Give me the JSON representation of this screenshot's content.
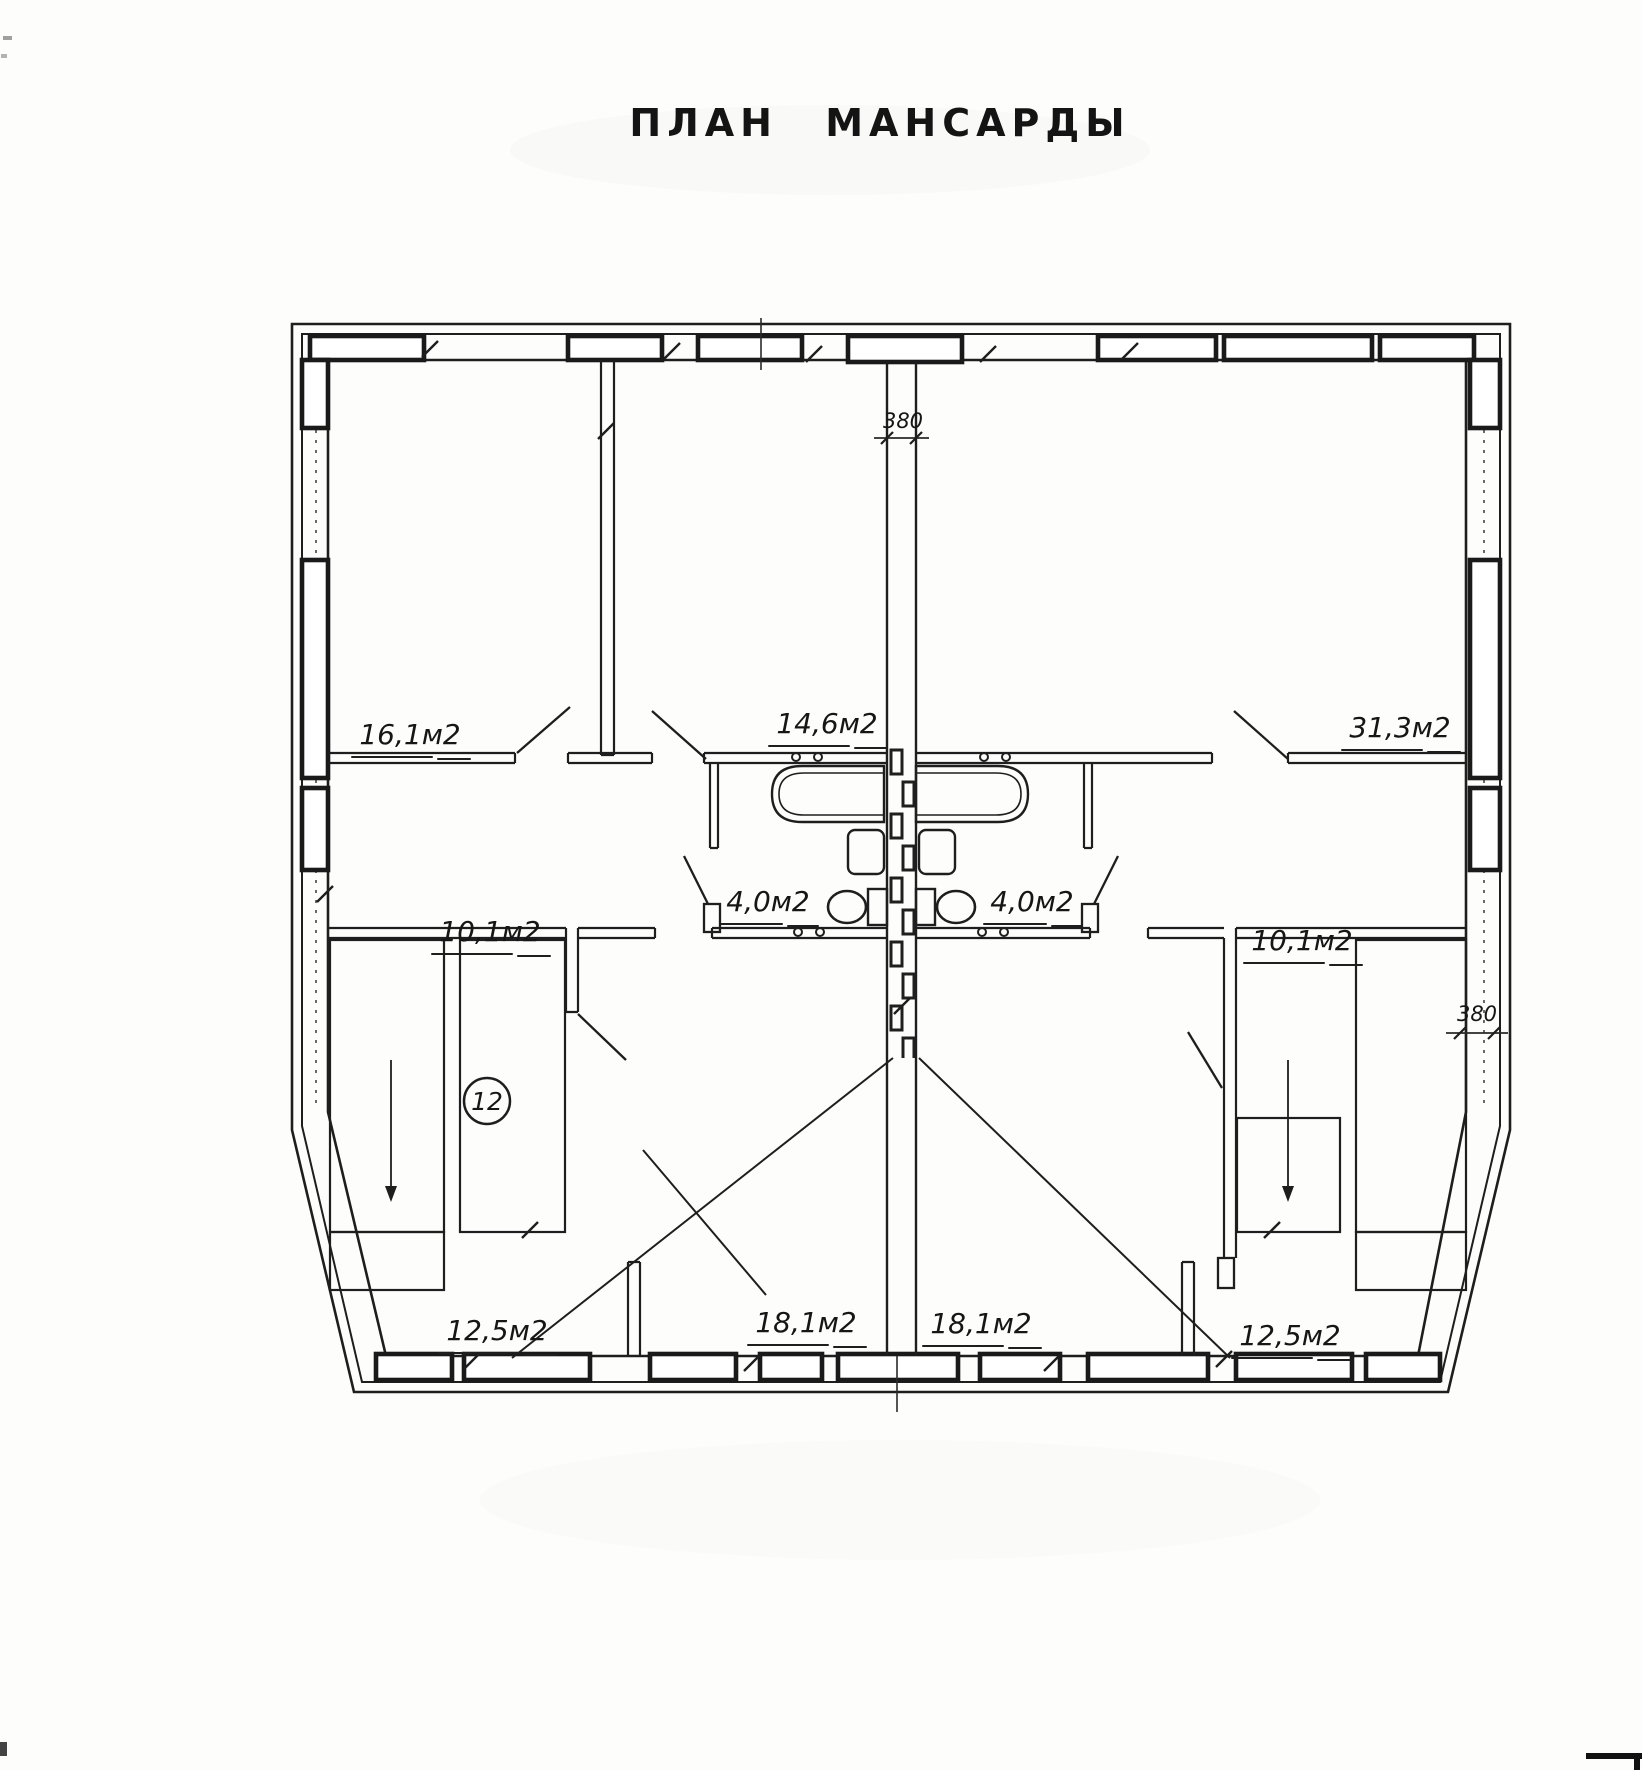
{
  "title": "ПЛАН МАНСАРДЫ",
  "rooms": {
    "top_left": {
      "area": "16,1м2"
    },
    "top_middle": {
      "area": "14,6м2"
    },
    "top_right": {
      "area": "31,3м2"
    },
    "bathroom_left": {
      "area": "4,0м2"
    },
    "bathroom_right": {
      "area": "4,0м2"
    },
    "hall_left": {
      "area": "10,1м2"
    },
    "hall_right": {
      "area": "10,1м2"
    },
    "bottom_far_left": {
      "area": "12,5м2"
    },
    "bottom_center_left": {
      "area": "18,1м2"
    },
    "bottom_center_right": {
      "area": "18,1м2"
    },
    "bottom_far_right": {
      "area": "12,5м2"
    }
  },
  "annotations": {
    "stair_number": "12",
    "wall_thickness_top": "380",
    "wall_thickness_right": "380"
  }
}
